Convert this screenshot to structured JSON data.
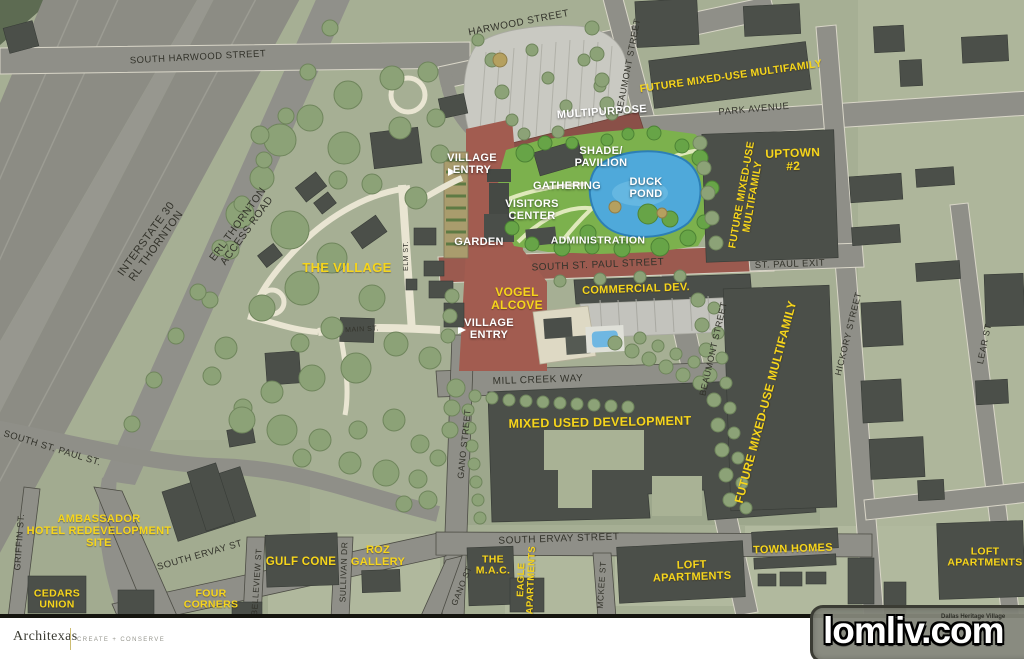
{
  "footer": {
    "logo": "Architexas",
    "tagline": "CREATE + CONSERVE"
  },
  "watermark": {
    "text": "lomliv.com",
    "caption": "Dallas Heritage Village"
  },
  "colors": {
    "label_yellow": "#f6d51c",
    "label_white": "#ffffff",
    "street_text": "#33332b",
    "building": "#4b4f49",
    "road": "#8f8f88",
    "land": "#a6af94",
    "park": "#7cb14d",
    "pond": "#4fa9da",
    "plaza": "#a25c50"
  },
  "labels": {
    "streets": [
      {
        "name": "harwood-street",
        "lines": [
          "HARWOOD STREET"
        ],
        "x": 519,
        "y": 24,
        "rot": -11,
        "size": 10
      },
      {
        "name": "south-harwood-street",
        "lines": [
          "SOUTH HARWOOD STREET"
        ],
        "x": 198,
        "y": 58,
        "rot": -3,
        "size": 9.5
      },
      {
        "name": "beaumont-street-north",
        "lines": [
          "BEAUMONT STREET"
        ],
        "x": 629,
        "y": 66,
        "rot": -79,
        "size": 9
      },
      {
        "name": "park-avenue",
        "lines": [
          "PARK AVENUE"
        ],
        "x": 754,
        "y": 110,
        "rot": -5,
        "size": 9.5
      },
      {
        "name": "st-paul-exit",
        "lines": [
          "ST. PAUL EXIT"
        ],
        "x": 790,
        "y": 265,
        "rot": -2,
        "size": 9.5
      },
      {
        "name": "south-st-paul-street",
        "lines": [
          "SOUTH ST. PAUL STREET"
        ],
        "x": 598,
        "y": 266,
        "rot": -2.5,
        "size": 10
      },
      {
        "name": "beaumont-street-mid",
        "lines": [
          "BEAUMONT STREET"
        ],
        "x": 714,
        "y": 349,
        "rot": -77,
        "size": 9
      },
      {
        "name": "hickory-street",
        "lines": [
          "HICKORY STREET"
        ],
        "x": 849,
        "y": 334,
        "rot": -76,
        "size": 9
      },
      {
        "name": "lear-st",
        "lines": [
          "LEAR ST"
        ],
        "x": 985,
        "y": 344,
        "rot": -78,
        "size": 9
      },
      {
        "name": "mill-creek-way",
        "lines": [
          "MILL CREEK WAY"
        ],
        "x": 538,
        "y": 381,
        "rot": -2,
        "size": 10
      },
      {
        "name": "gano-street",
        "lines": [
          "GANO STREET"
        ],
        "x": 465,
        "y": 444,
        "rot": -84,
        "size": 9
      },
      {
        "name": "gano-st-south",
        "lines": [
          "GANO ST"
        ],
        "x": 462,
        "y": 586,
        "rot": -68,
        "size": 8.5
      },
      {
        "name": "south-ervay-street",
        "lines": [
          "SOUTH ERVAY STREET"
        ],
        "x": 559,
        "y": 540,
        "rot": -2,
        "size": 10
      },
      {
        "name": "south-ervay-st-west",
        "lines": [
          "SOUTH ERVAY ST"
        ],
        "x": 200,
        "y": 556,
        "rot": -16,
        "size": 9.5
      },
      {
        "name": "south-st-paul-st-west",
        "lines": [
          "SOUTH ST. PAUL ST."
        ],
        "x": 52,
        "y": 449,
        "rot": 17,
        "size": 9.5
      },
      {
        "name": "griffin-st",
        "lines": [
          "GRIFFIN ST."
        ],
        "x": 20,
        "y": 542,
        "rot": -86,
        "size": 9
      },
      {
        "name": "belleview-st",
        "lines": [
          "BELLEVIEW ST"
        ],
        "x": 257,
        "y": 582,
        "rot": -86,
        "size": 8.5
      },
      {
        "name": "sullivan-dr",
        "lines": [
          "SULLIVAN DR"
        ],
        "x": 344,
        "y": 572,
        "rot": -88,
        "size": 8.5
      },
      {
        "name": "mckee-st",
        "lines": [
          "MCKEE ST"
        ],
        "x": 602,
        "y": 585,
        "rot": -86,
        "size": 8.5
      },
      {
        "name": "elm-st",
        "lines": [
          "ELM ST."
        ],
        "x": 407,
        "y": 256,
        "rot": -90,
        "size": 7
      },
      {
        "name": "main-st",
        "lines": [
          "MAIN ST."
        ],
        "x": 362,
        "y": 330,
        "rot": -3,
        "size": 7
      },
      {
        "name": "interstate-30",
        "lines": [
          "INTERSTATE 30",
          "RL THORNTON"
        ],
        "x": 152,
        "y": 243,
        "rot": -54,
        "size": 11
      },
      {
        "name": "erl-thornton-access",
        "lines": [
          "ERL THORNTON",
          "ACCESS ROAD"
        ],
        "x": 243,
        "y": 228,
        "rot": -54,
        "size": 10.5
      }
    ],
    "places": [
      {
        "name": "future-mixed-use-north",
        "lines": [
          "FUTURE MIXED-USE MULTIFAMILY"
        ],
        "x": 731,
        "y": 77,
        "rot": -8,
        "size": 10.5
      },
      {
        "name": "uptown-2",
        "lines": [
          "UPTOWN",
          "#2"
        ],
        "x": 793,
        "y": 160,
        "rot": -2,
        "size": 12
      },
      {
        "name": "future-mixed-use-uptown",
        "lines": [
          "FUTURE MIXED-USE",
          "MULTIFAMILY"
        ],
        "x": 748,
        "y": 196,
        "rot": -80,
        "size": 10.5
      },
      {
        "name": "future-mixed-use-east",
        "lines": [
          "FUTURE MIXED-USE MULTIFAMILY"
        ],
        "x": 766,
        "y": 402,
        "rot": -75,
        "size": 12
      },
      {
        "name": "the-village",
        "lines": [
          "THE VILLAGE"
        ],
        "x": 347,
        "y": 268,
        "rot": 0,
        "size": 13
      },
      {
        "name": "vogel-alcove",
        "lines": [
          "VOGEL",
          "ALCOVE"
        ],
        "x": 517,
        "y": 299,
        "rot": 0,
        "size": 12
      },
      {
        "name": "commercial-dev",
        "lines": [
          "COMMERCIAL DEV."
        ],
        "x": 636,
        "y": 290,
        "rot": -2,
        "size": 11
      },
      {
        "name": "mixed-used-development",
        "lines": [
          "MIXED USED DEVELOPMENT"
        ],
        "x": 600,
        "y": 423,
        "rot": -1,
        "size": 12.5
      },
      {
        "name": "ambassador-hotel",
        "lines": [
          "AMBASSADOR",
          "HOTEL REDEVELOPMENT",
          "SITE"
        ],
        "x": 99,
        "y": 532,
        "rot": 0,
        "size": 11
      },
      {
        "name": "gulf-cone",
        "lines": [
          "GULF CONE"
        ],
        "x": 301,
        "y": 562,
        "rot": 0,
        "size": 11.5
      },
      {
        "name": "roz-gallery",
        "lines": [
          "ROZ",
          "GALLERY"
        ],
        "x": 378,
        "y": 557,
        "rot": 0,
        "size": 11
      },
      {
        "name": "the-mac",
        "lines": [
          "THE",
          "M.A.C."
        ],
        "x": 493,
        "y": 566,
        "rot": 0,
        "size": 10.5
      },
      {
        "name": "eagle-apartments",
        "lines": [
          "EAGLE",
          "APARTMENTS"
        ],
        "x": 527,
        "y": 580,
        "rot": -88,
        "size": 9.5
      },
      {
        "name": "four-corners",
        "lines": [
          "FOUR",
          "CORNERS"
        ],
        "x": 211,
        "y": 600,
        "rot": 0,
        "size": 10.5
      },
      {
        "name": "cedars-union",
        "lines": [
          "CEDARS",
          "UNION"
        ],
        "x": 57,
        "y": 600,
        "rot": 0,
        "size": 10.5
      },
      {
        "name": "town-homes",
        "lines": [
          "TOWN HOMES"
        ],
        "x": 793,
        "y": 550,
        "rot": -2,
        "size": 11
      },
      {
        "name": "loft-apartments-west",
        "lines": [
          "LOFT",
          "APARTMENTS"
        ],
        "x": 692,
        "y": 572,
        "rot": -2,
        "size": 11
      },
      {
        "name": "loft-apartments-east",
        "lines": [
          "LOFT",
          "APARTMENTS"
        ],
        "x": 985,
        "y": 558,
        "rot": 0,
        "size": 10.5
      }
    ],
    "areas": [
      {
        "name": "village-entry-north",
        "lines": [
          "VILLAGE",
          "ENTRY"
        ],
        "x": 472,
        "y": 165,
        "rot": 0,
        "size": 11
      },
      {
        "name": "multipurpose",
        "lines": [
          "MULTIPURPOSE"
        ],
        "x": 602,
        "y": 113,
        "rot": -4,
        "size": 11
      },
      {
        "name": "shade-pavilion",
        "lines": [
          "SHADE/",
          "PAVILION"
        ],
        "x": 601,
        "y": 158,
        "rot": 0,
        "size": 11
      },
      {
        "name": "duck-pond",
        "lines": [
          "DUCK",
          "POND"
        ],
        "x": 646,
        "y": 189,
        "rot": 0,
        "size": 11
      },
      {
        "name": "gathering",
        "lines": [
          "GATHERING"
        ],
        "x": 567,
        "y": 187,
        "rot": 0,
        "size": 11
      },
      {
        "name": "visitors-center",
        "lines": [
          "VISITORS",
          "CENTER"
        ],
        "x": 532,
        "y": 211,
        "rot": 0,
        "size": 11
      },
      {
        "name": "garden",
        "lines": [
          "GARDEN"
        ],
        "x": 479,
        "y": 243,
        "rot": 0,
        "size": 11
      },
      {
        "name": "administration",
        "lines": [
          "ADMINISTRATION"
        ],
        "x": 598,
        "y": 241,
        "rot": 0,
        "size": 10.5
      },
      {
        "name": "village-entry-south",
        "lines": [
          "VILLAGE",
          "ENTRY"
        ],
        "x": 489,
        "y": 330,
        "rot": 0,
        "size": 11
      }
    ]
  }
}
